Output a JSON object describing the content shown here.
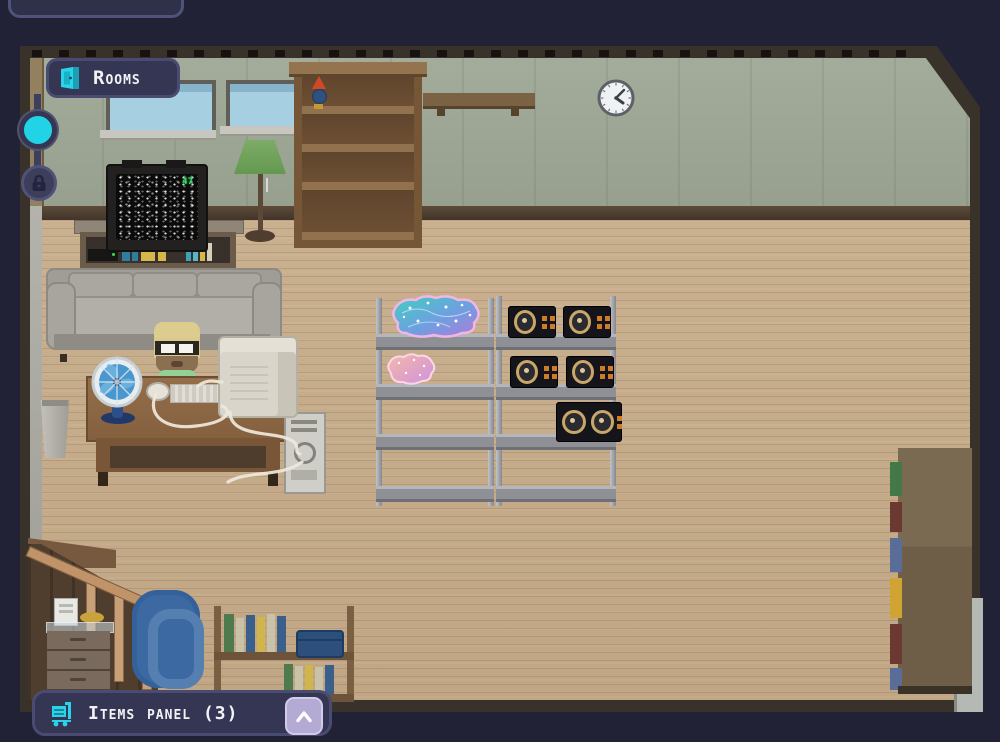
{
  "ui": {
    "rooms_button": {
      "label": "Rooms",
      "icon": "door-icon"
    },
    "nav_chain": {
      "active_dot": "current-room-indicator",
      "locked_item": "lock-icon"
    },
    "items_panel": {
      "label": "Items panel (3)",
      "count": 3,
      "icon": "cart-icon",
      "collapse_icon": "chevron-up-icon"
    },
    "colors": {
      "accent_cyan": "#29d4e8",
      "panel_bg": "#343654",
      "panel_border": "#494b70",
      "chevron_button": "#b3abd4",
      "background": "#212236"
    }
  },
  "room": {
    "tv": {
      "channel": "47"
    },
    "objects": [
      "window",
      "window",
      "tall-bookshelf",
      "party-trophy",
      "wall-shelf",
      "wall-clock",
      "crt-tv",
      "media-console",
      "couch",
      "floor-lamp",
      "trash-can",
      "desk",
      "desk-fan",
      "computer-mouse",
      "keyboard",
      "crt-monitor",
      "pc-tower",
      "character",
      "metal-shelf",
      "metal-shelf",
      "glowing-brain-large",
      "glowing-brain-small",
      "speaker",
      "speaker",
      "speaker",
      "speaker",
      "speaker-double",
      "staircase",
      "nightstand",
      "radio",
      "bowl",
      "blue-rug",
      "low-bookshelf",
      "book-chest",
      "side-wardrobe"
    ]
  }
}
